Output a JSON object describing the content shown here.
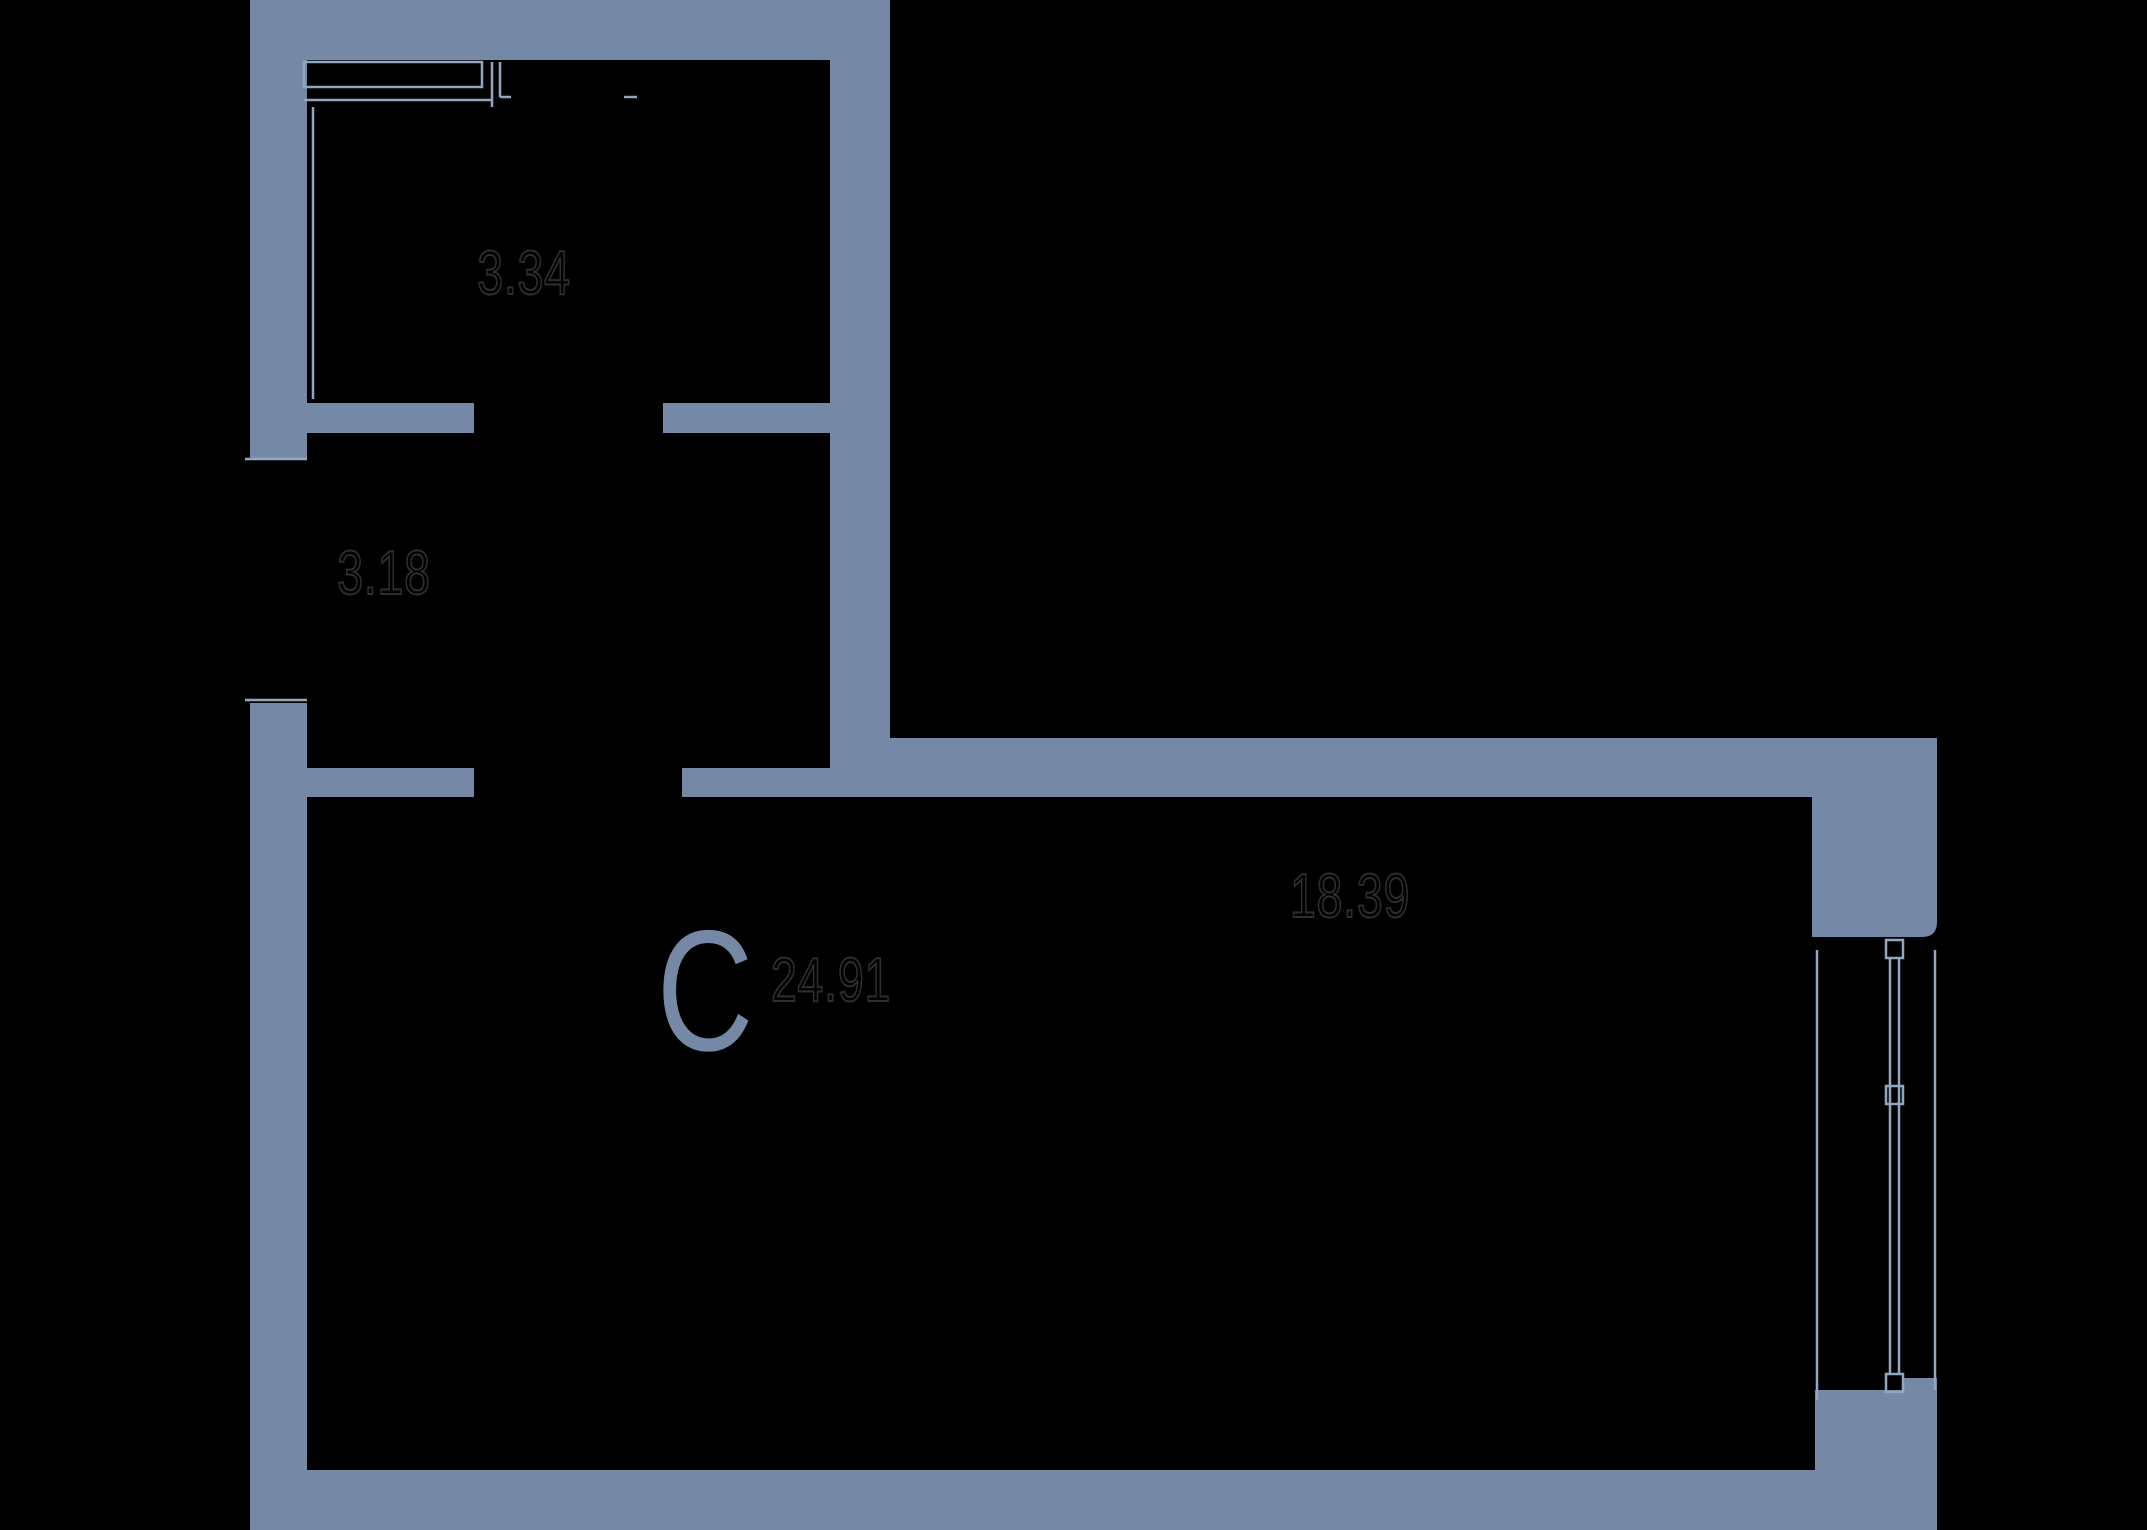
{
  "section": {
    "letter": "C"
  },
  "areas": {
    "upper_room": "3.34",
    "hallway": "3.18",
    "main_room": "18.39",
    "total": "24.91"
  },
  "colors": {
    "background": "#000000",
    "wall": "#7589a7",
    "line": "#93a6c1",
    "labelOutline": "#2e2e2e"
  }
}
